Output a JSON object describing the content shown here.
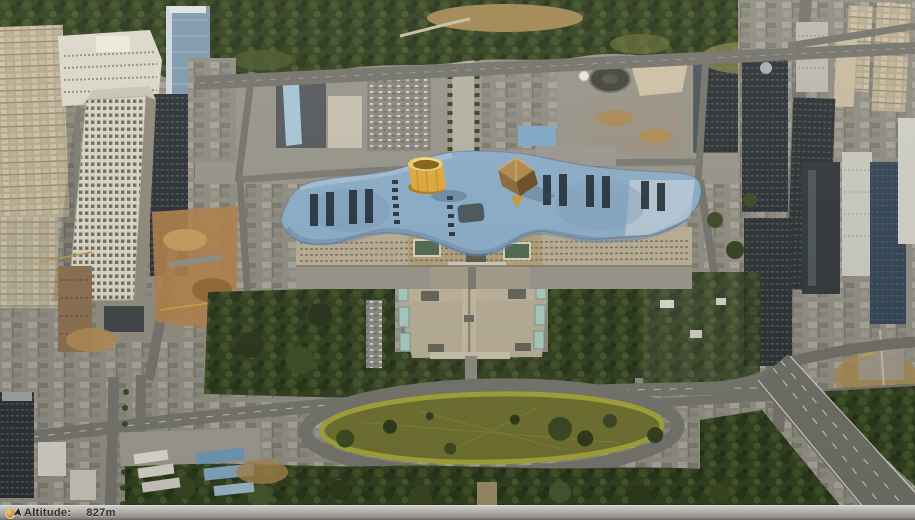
{
  "status_bar": {
    "altitude_label": "Altitude:",
    "altitude_value": "827m",
    "left_icon": "globe-icon",
    "right_icon": "north-arrow-icon"
  },
  "colors": {
    "roof_blue": "#8badc9",
    "cone_gold": "#dfa93c",
    "pyramid_brown": "#8a6a38",
    "lawn_olive": "#6e7030",
    "plaza_tan": "#b7ad96",
    "forest_green": "#31401f",
    "road_gray": "#74736c",
    "status_bar_gray": "#aeaca7"
  }
}
